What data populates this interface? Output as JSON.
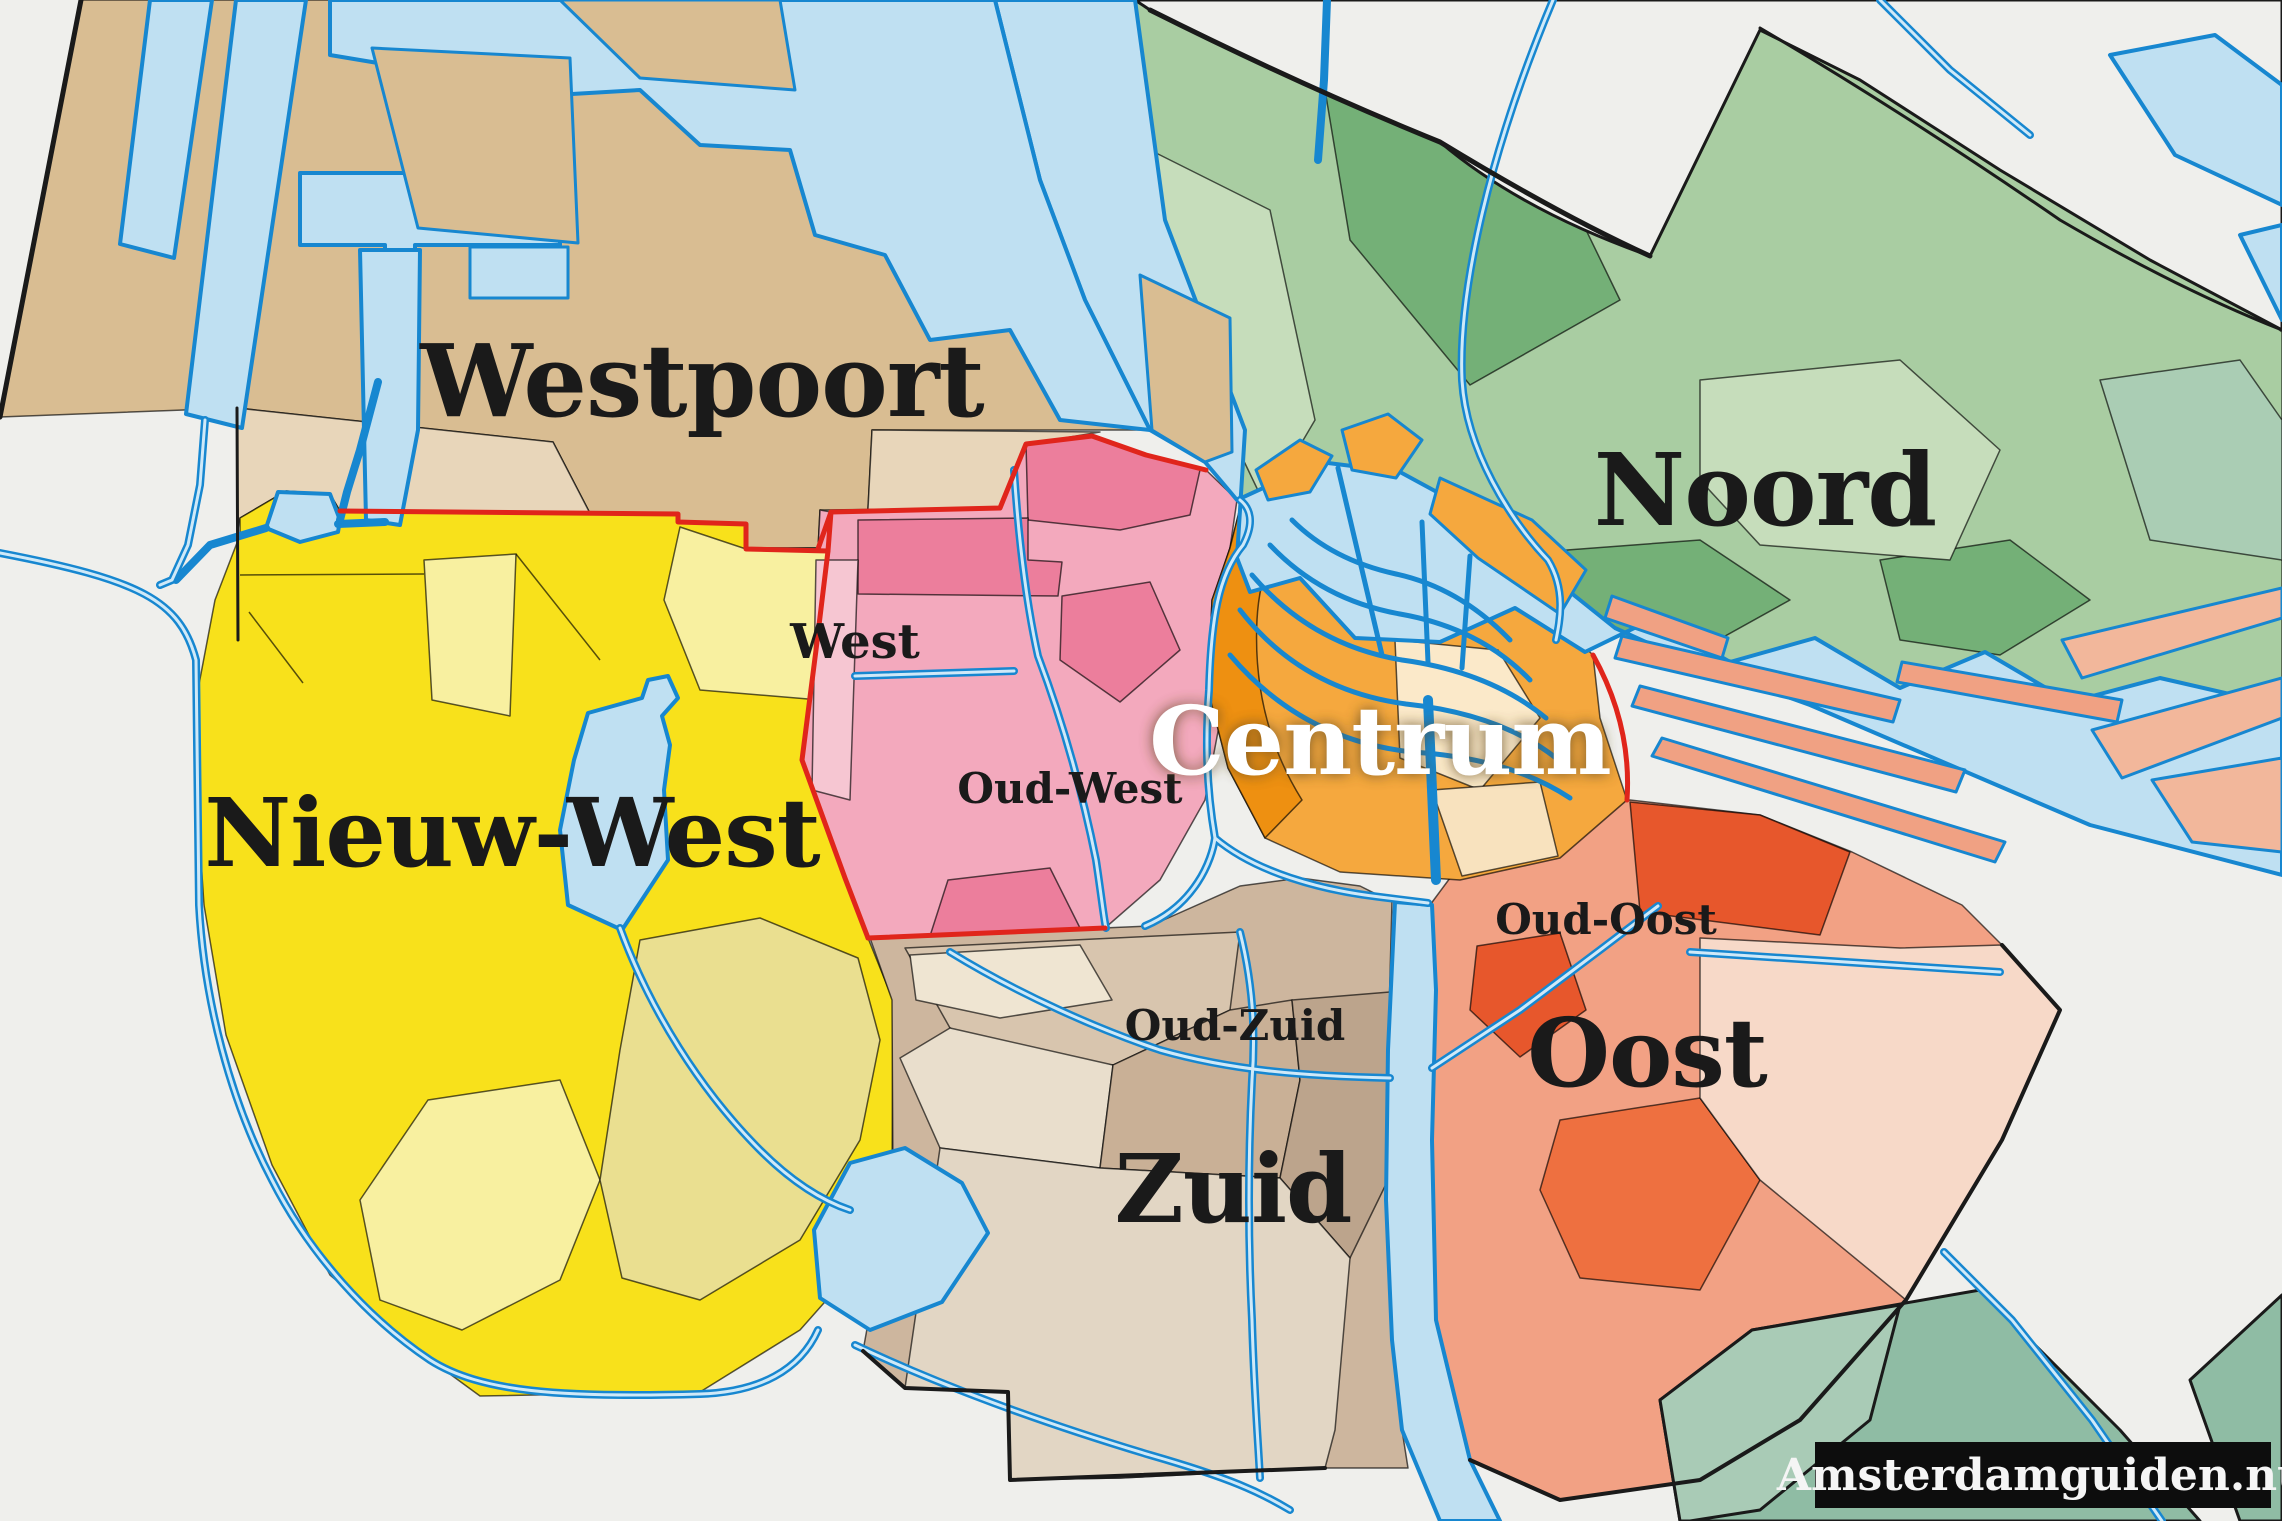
{
  "map": {
    "title": "Amsterdam stadsdelen map",
    "watermark": "Amsterdamguiden.nu",
    "labels": {
      "westpoort": "Westpoort",
      "noord": "Noord",
      "nieuw_west": "Nieuw-West",
      "west": "West",
      "oud_west": "Oud-West",
      "centrum": "Centrum",
      "oud_oost": "Oud-Oost",
      "oost": "Oost",
      "oud_zuid": "Oud-Zuid",
      "zuid": "Zuid"
    },
    "districts": [
      {
        "name": "Westpoort",
        "color": "#d9bd92"
      },
      {
        "name": "Noord",
        "color": "#a9cda2"
      },
      {
        "name": "Nieuw-West",
        "color": "#f8e11b"
      },
      {
        "name": "West",
        "color": "#f3a9bd"
      },
      {
        "name": "Centrum",
        "color": "#f5a83e"
      },
      {
        "name": "Oost",
        "color": "#f2a184"
      },
      {
        "name": "Zuid",
        "color": "#cdb69e"
      }
    ],
    "colors": {
      "background": "#efefec",
      "water_fill": "#bfe0f2",
      "water_stroke": "#1787d0",
      "canal_inner": "#cfe9f8",
      "westpoort": "#d9bd92",
      "westpoort_light": "#e8d6ba",
      "noord": "#a9cda2",
      "noord_dark": "#74b077",
      "noord_light": "#c6ddbb",
      "noord_teal": "#aacdb4",
      "teal_island": "#8fbca4",
      "teal_island_light": "#a9cbb6",
      "nieuw_west": "#f8e11b",
      "nieuw_west_light": "#f8f0a0",
      "nieuw_west_olive": "#eadf90",
      "west": "#f3a9bd",
      "west_dark": "#ec7e9c",
      "west_light": "#f6c6d2",
      "centrum": "#f5a83e",
      "centrum_dark": "#ee9011",
      "centrum_cream": "#fbe9c9",
      "oost": "#f2a184",
      "oost_red": "#e7572c",
      "oost_orange": "#ee7040",
      "oost_pale": "#f7d9c8",
      "ijburg": "#f2b79b",
      "zuid": "#cdb69e",
      "zuid_beige": "#d8c5ae",
      "zuid_cream": "#e9decc",
      "zuid_dark": "#bca48c",
      "zuid_light": "#e2d6c4",
      "border_red": "#e0251b",
      "border_black": "#1a1a1a",
      "label": "#1a1a1a",
      "label_light": "#ffffff",
      "centrum_shadow": "#5f4a22",
      "watermark_bg": "#0d0d0d",
      "watermark_text": "#f5f5f5"
    }
  }
}
